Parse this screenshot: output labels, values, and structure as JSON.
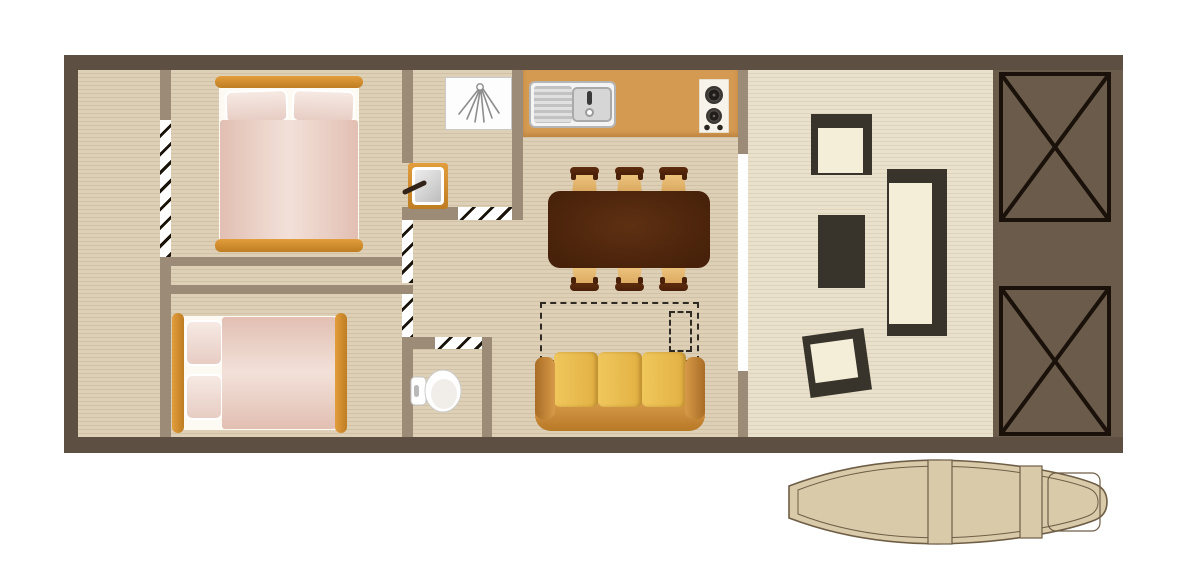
{
  "floorplan": {
    "colors": {
      "wall-dark": "#5d4f41",
      "wall-inner": "#9c8c77",
      "floor-a": "#ddd0b6",
      "floor-b": "#d1c2a5",
      "deck-a": "#eae1cd",
      "deck-b": "#ded3bb",
      "counter": "#d59a52",
      "platform": "#6b5b4a",
      "frame-orange-1": "#e29d3c",
      "frame-orange-2": "#bf7d22",
      "linen-white": "#fdfaf4",
      "pillow-1": "#f6e9e3",
      "pillow-2": "#e7cdc4",
      "duvet-edge": "#e2bfb2",
      "duvet-mid": "#f2e1d9",
      "table-edge": "#47210a",
      "table-mid": "#5e3012",
      "chair-tan-1": "#f0c882",
      "chair-tan-2": "#d9a75e",
      "chair-dark": "#4a2008",
      "sofa-c1": "#f0c75c",
      "sofa-c2": "#e2b042",
      "sofa-arm-1": "#a96d24",
      "sofa-arm-2": "#d79a49",
      "sofa-base-1": "#d99f4c",
      "sofa-base-2": "#b97927",
      "patio-dark": "#38342b",
      "patio-cream": "#f4eed9",
      "x-line": "#1a120a",
      "boat-fill": "#d9caaa",
      "boat-line": "#6f5e46",
      "hatch-line": "#1a130a",
      "fixture-line": "#c9c9c9",
      "steel-1": "#e0e0e0",
      "steel-2": "#c2c2c2",
      "icon-gray": "#8d8d8d"
    },
    "rooms": [
      {
        "name": "side-deck"
      },
      {
        "name": "bedroom-1",
        "furniture": [
          "double-bed"
        ]
      },
      {
        "name": "bedroom-2",
        "furniture": [
          "double-bed"
        ]
      },
      {
        "name": "bathroom",
        "furniture": [
          "shower",
          "washbasin"
        ]
      },
      {
        "name": "wc",
        "furniture": [
          "toilet"
        ]
      },
      {
        "name": "kitchen",
        "furniture": [
          "counter",
          "sink-with-drainboard",
          "hob-2-burner"
        ]
      },
      {
        "name": "dining-area",
        "furniture": [
          "table",
          "chair",
          "chair",
          "chair",
          "chair",
          "chair",
          "chair"
        ]
      },
      {
        "name": "living-area",
        "furniture": [
          "sofa",
          "sofa-bed-dashed-outline"
        ]
      },
      {
        "name": "terrace",
        "furniture": [
          "patio-chair",
          "patio-side-table",
          "patio-lounger",
          "patio-chair"
        ]
      },
      {
        "name": "rear-platform",
        "furniture": [
          "crossed-box",
          "crossed-box"
        ]
      },
      {
        "name": "canoe",
        "furniture": [
          "bench",
          "bench"
        ]
      }
    ]
  }
}
